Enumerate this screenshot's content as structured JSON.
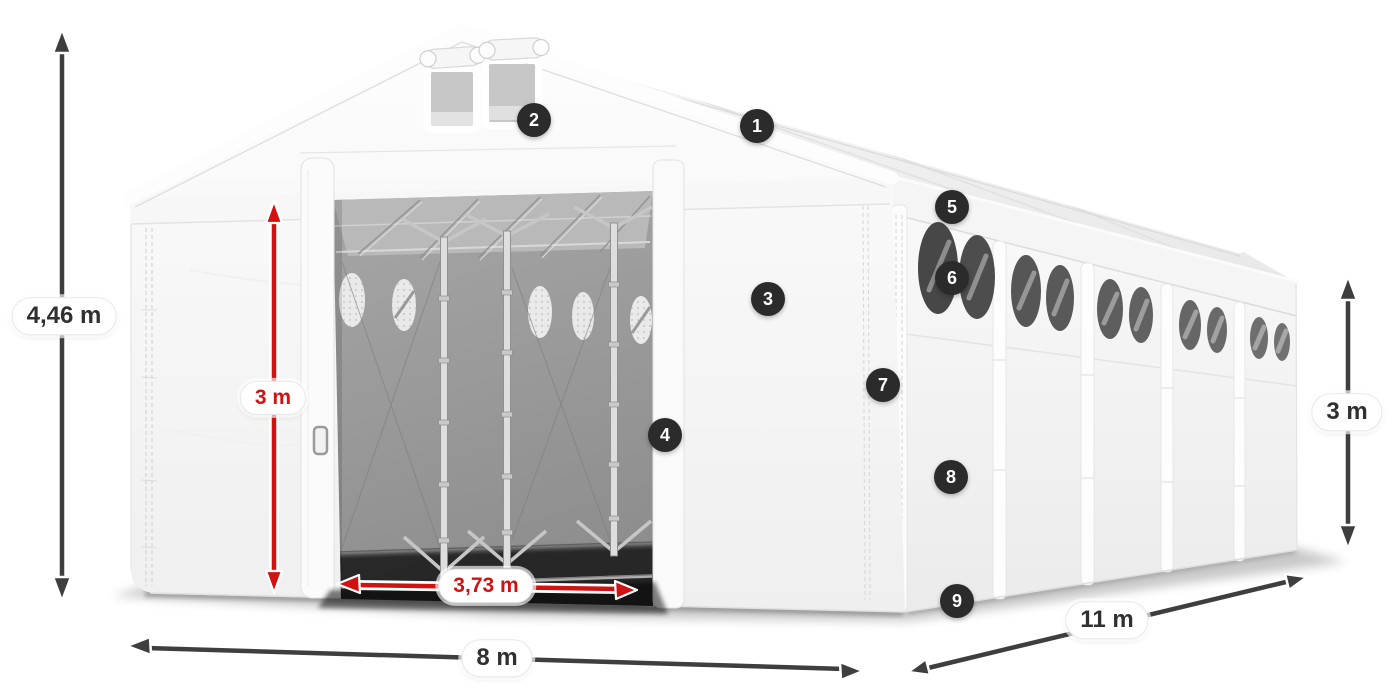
{
  "diagram": {
    "name": "storage-tent-dimensions-diagram",
    "dimensions": {
      "total_height": {
        "label": "4,46 m",
        "style": "dark"
      },
      "door_height": {
        "label": "3 m",
        "style": "red"
      },
      "door_width": {
        "label": "3,73 m",
        "style": "red"
      },
      "front_width": {
        "label": "8 m",
        "style": "dark"
      },
      "side_length": {
        "label": "11 m",
        "style": "dark"
      },
      "side_height": {
        "label": "3 m",
        "style": "dark"
      }
    },
    "callouts": [
      {
        "number": "1"
      },
      {
        "number": "2"
      },
      {
        "number": "3"
      },
      {
        "number": "4"
      },
      {
        "number": "5"
      },
      {
        "number": "6"
      },
      {
        "number": "7"
      },
      {
        "number": "8"
      },
      {
        "number": "9"
      }
    ],
    "colors": {
      "red_accent": "#d11212",
      "arrow_dark": "#3e3e3e",
      "badge_background": "#2b2b2b",
      "label_text_dark": "#303030",
      "tent_white": "#f7f7f7"
    }
  }
}
